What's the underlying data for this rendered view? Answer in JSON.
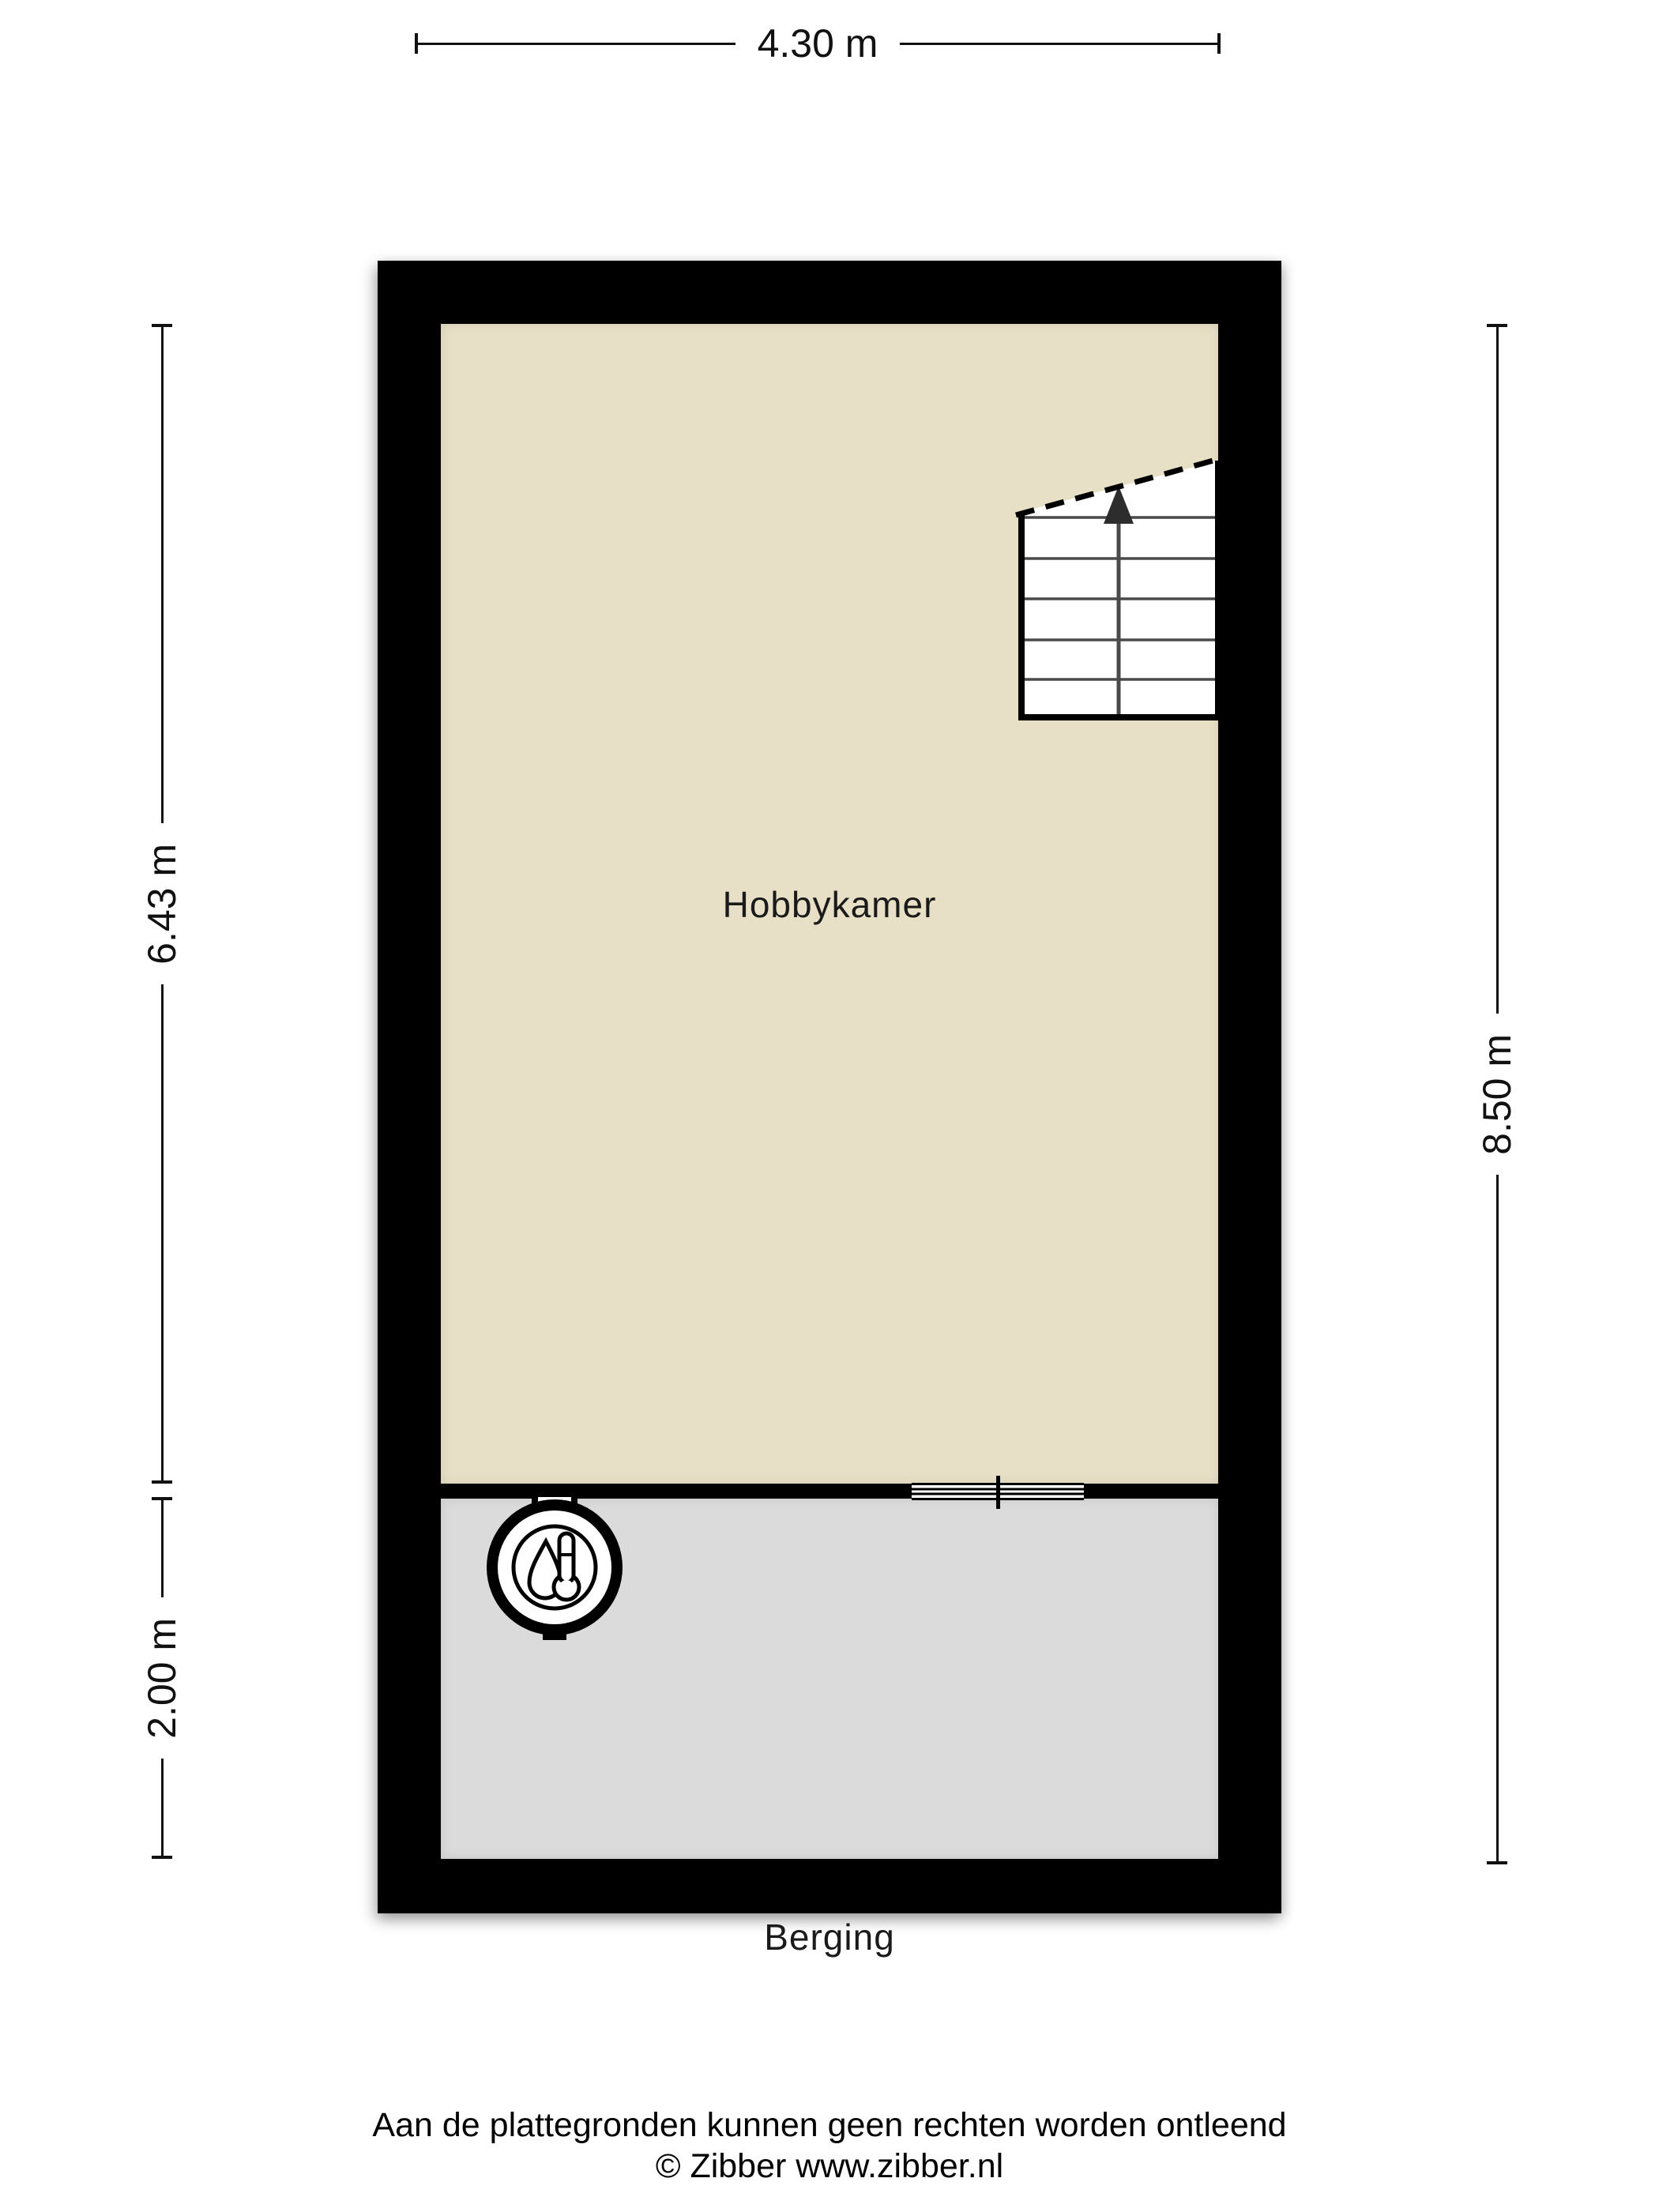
{
  "plan": {
    "type": "floorplan",
    "rooms": [
      {
        "name": "Hobbykamer",
        "floor_color": "#e8e0c6"
      },
      {
        "name": "Berging",
        "floor_color": "#dbdbdb"
      }
    ],
    "dimensions": {
      "width_top": "4.30 m",
      "height_upper_left": "6.43 m",
      "height_lower_left": "2.00 m",
      "height_right": "8.50 m"
    },
    "icons": {
      "boiler": "boiler-thermometer-icon",
      "stairs_arrow": "arrow-up-icon",
      "door": "sliding-door-symbol"
    },
    "colors": {
      "wall": "#000000",
      "background": "#ffffff",
      "dimension_line": "#111111"
    }
  },
  "footer": {
    "disclaimer": "Aan de plattegronden kunnen geen rechten worden ontleend",
    "copyright": "© Zibber www.zibber.nl"
  }
}
